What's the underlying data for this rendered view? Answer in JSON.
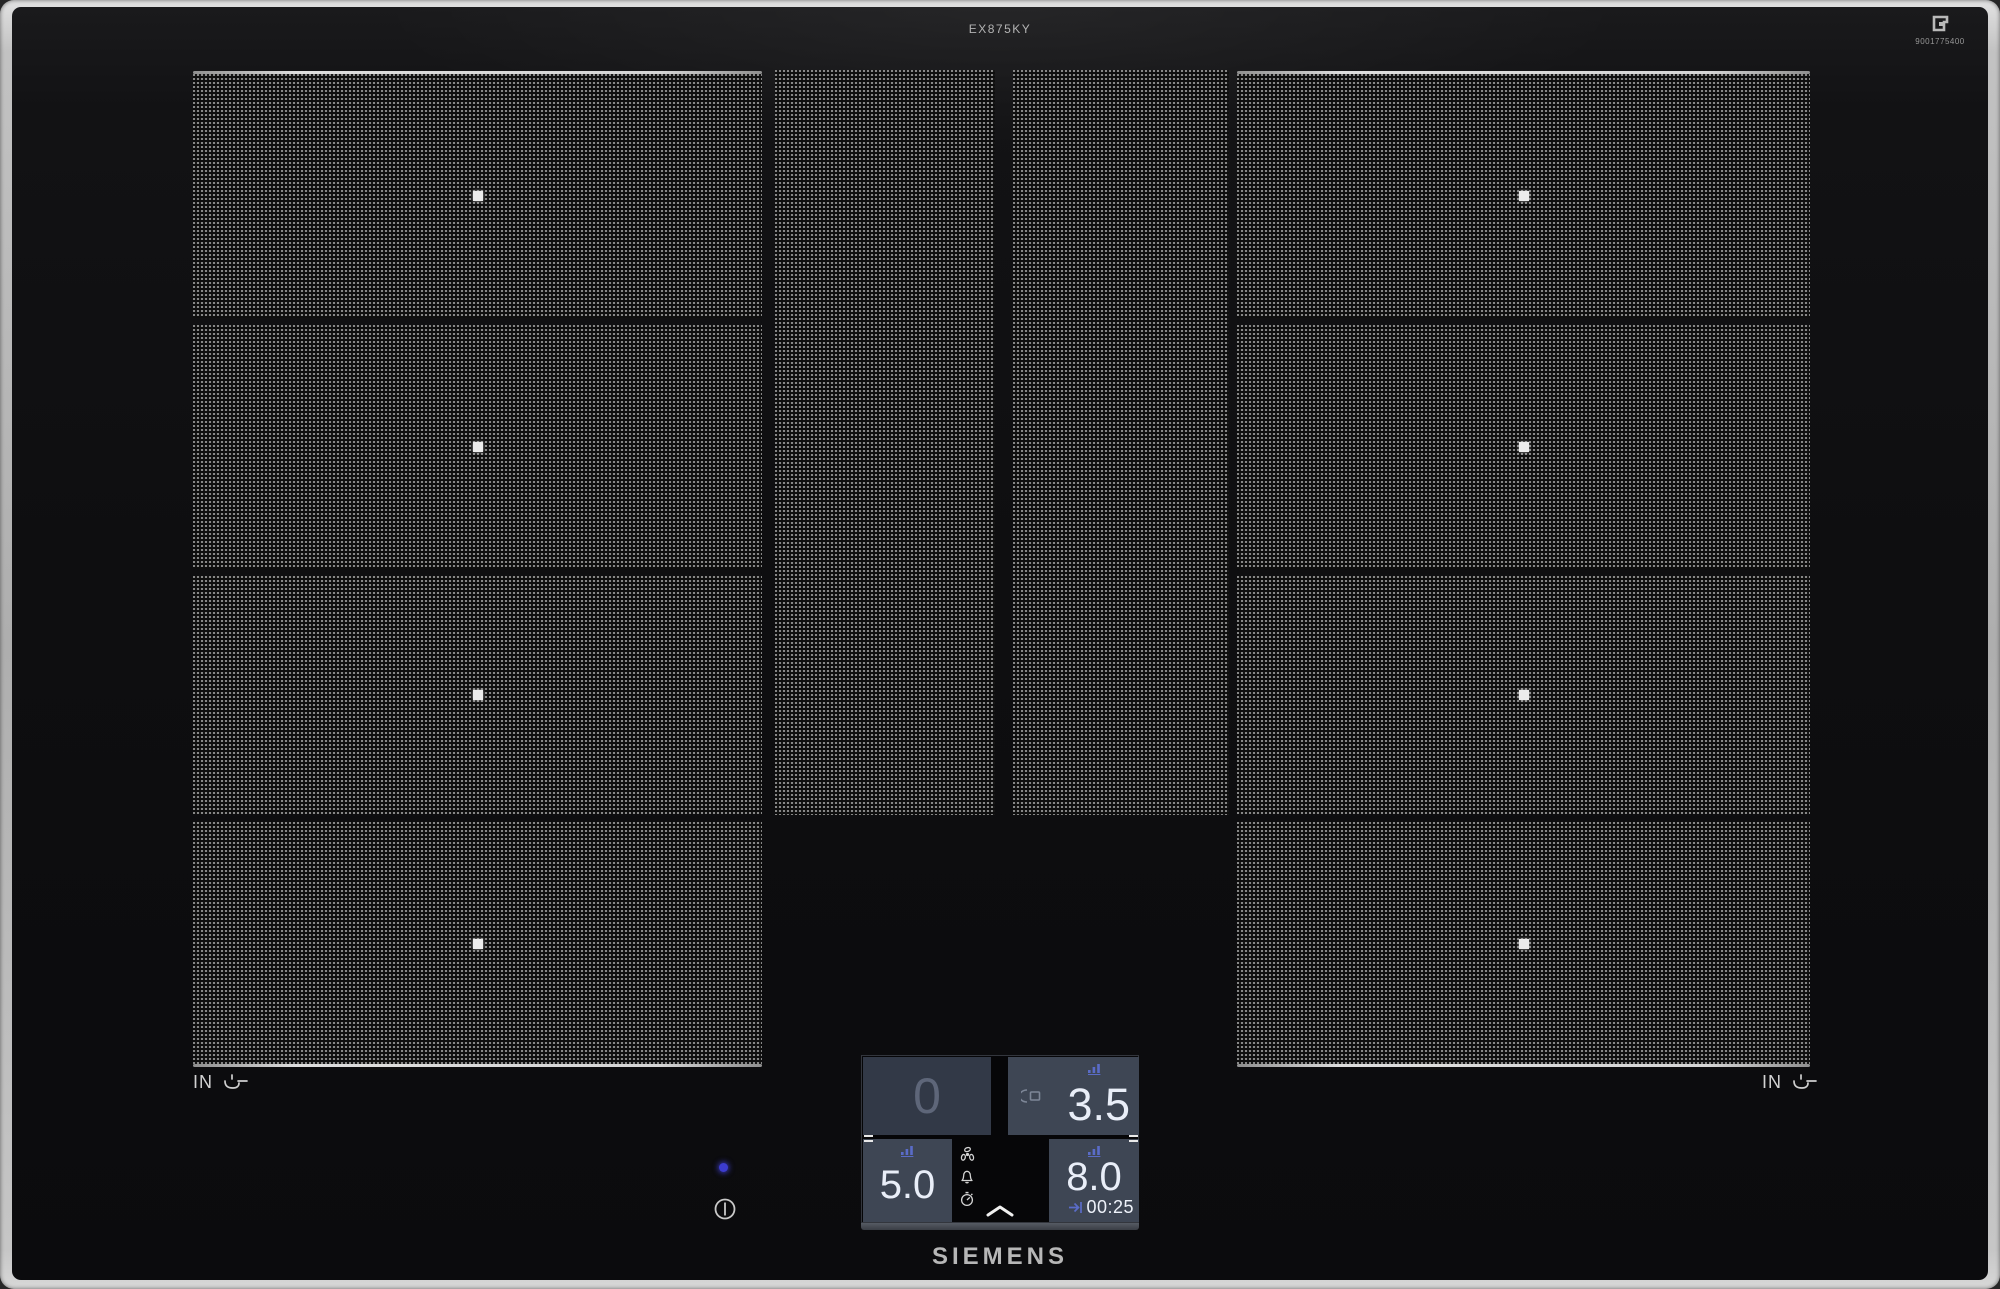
{
  "device": {
    "model": "EX875KY",
    "part_number": "9001775400",
    "brand": "SIEMENS"
  },
  "hob": {
    "pan_indicator_left": "IN",
    "pan_indicator_right": "IN",
    "zone_layout": "four flexInduction areas: left 4-segment zone, two center strips, right 4-segment zone"
  },
  "control_panel": {
    "top_left": {
      "power": "0"
    },
    "top_right": {
      "power": "3.5"
    },
    "bottom_left": {
      "power": "5.0"
    },
    "bottom_right": {
      "power": "8.0",
      "timer_end": "00:25"
    }
  },
  "icons": {
    "center_column": [
      "fan",
      "bell",
      "stopwatch"
    ],
    "expand": "chevron-up",
    "per_zone": "power-level-bars",
    "top_right_zone_extra": "pan-bridge",
    "corner_mark": "flex-frame",
    "pan_indicator": "pan-with-sensor",
    "power": "power-button"
  },
  "colors": {
    "accent_blue": "#5a6cc8",
    "led_blue": "#3c3ccf",
    "panel_bg": "#3e4654",
    "panel_bg_dim": "#323947",
    "frame_metal": "#c2c2c2",
    "glass": "#0e0e10",
    "value_text": "#e9eef8"
  }
}
